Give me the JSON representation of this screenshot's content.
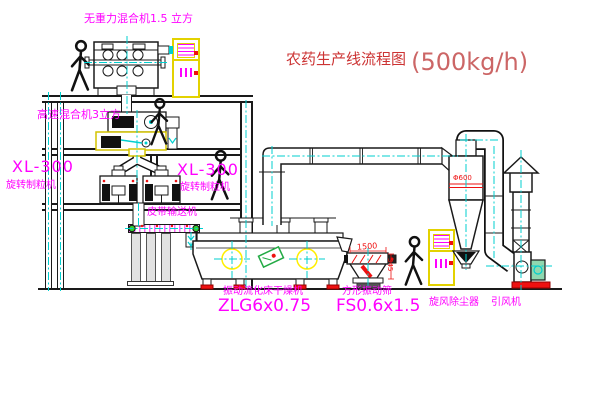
{
  "title": {
    "text": "农药生产线流程图",
    "capacity": "(500kg/h)"
  },
  "equipment_labels": {
    "gravity_free_mixer": "无重力混合机1.5 立方",
    "high_speed_mixer": "高速混合机3立方",
    "granulator_left": {
      "model": "XL-300",
      "name": "旋转制粒机"
    },
    "granulator_right": {
      "model": "XL-300",
      "name": "旋转制粒机"
    },
    "belt_conveyor": "皮带输送机",
    "fluid_bed_dryer": {
      "name": "振动流化床干燥机",
      "model": "ZLG6x0.75"
    },
    "vibrating_sieve": {
      "name": "方形振动筛",
      "model": "FS0.6x1.5"
    },
    "cyclone_dust_collector": "旋风除尘器",
    "induced_draft_fan": "引风机"
  },
  "annotations": {
    "sieve_length_dim": "1500",
    "sieve_height_dim": "345",
    "cyclone_tag": "Φ600"
  },
  "colors": {
    "label_magenta": "#ff00ff",
    "title_red": "#cc3333",
    "cabinet_yellow": "#e3d200",
    "centerline_cyan": "#00cfcf",
    "line_black": "#1a1a1a",
    "accent_red": "#ee1111",
    "machine_green": "#22aa44"
  }
}
